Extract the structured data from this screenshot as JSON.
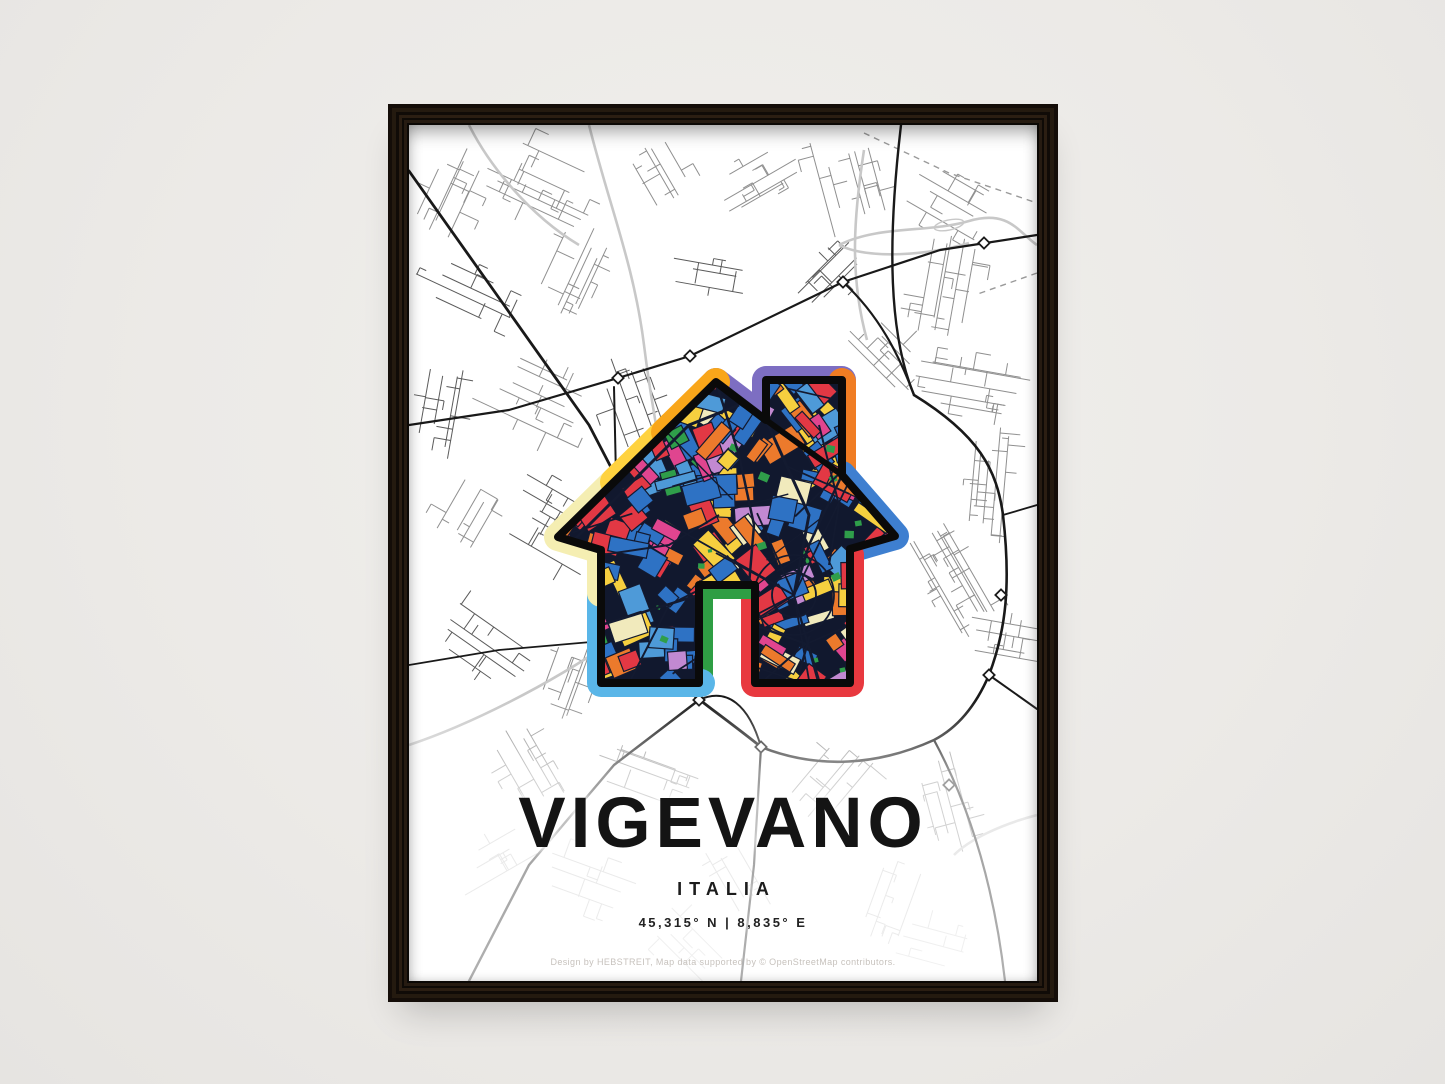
{
  "poster": {
    "title": "VIGEVANO",
    "subtitle": "ITALIA",
    "coordinates": "45,315° N | 8,835° E",
    "attribution": "Design by HEBSTREIT, Map data supported by © OpenStreetMap contributors."
  },
  "icon": {
    "name": "house-map-icon"
  },
  "colors": {
    "wall": "#eceae7",
    "frame_wood": "#241a0f",
    "paper": "#ffffff",
    "title_text": "#141414",
    "attribution_text": "#c7c2bd",
    "road_main": "#191919",
    "road_minor": "#8f8f8f",
    "road_minor_dark": "#5a5a5a",
    "road_light": "#c8c8c8",
    "road_faded": "#cccccc",
    "ring": {
      "cream": "#f5eeb2",
      "gold": "#ffd23f",
      "orange_left": "#f9a61a",
      "purple": "#7d6ec2",
      "orange_right": "#f07d23",
      "blue": "#3e7fd0",
      "red": "#e8393f",
      "green": "#2f9e44",
      "sky": "#5ab6e8"
    },
    "mosaic": {
      "base": "#11182e",
      "street": "#131a30",
      "outline": "#0a0a0a",
      "blue": "#2e72c4",
      "red": "#e23844",
      "orange": "#ec7a2c",
      "yellow": "#f6cf3f",
      "magenta": "#e0458f",
      "lilac": "#c289d2",
      "cream": "#f1eabc",
      "sky": "#4e9ad8",
      "green": "#2f9e4a"
    }
  }
}
